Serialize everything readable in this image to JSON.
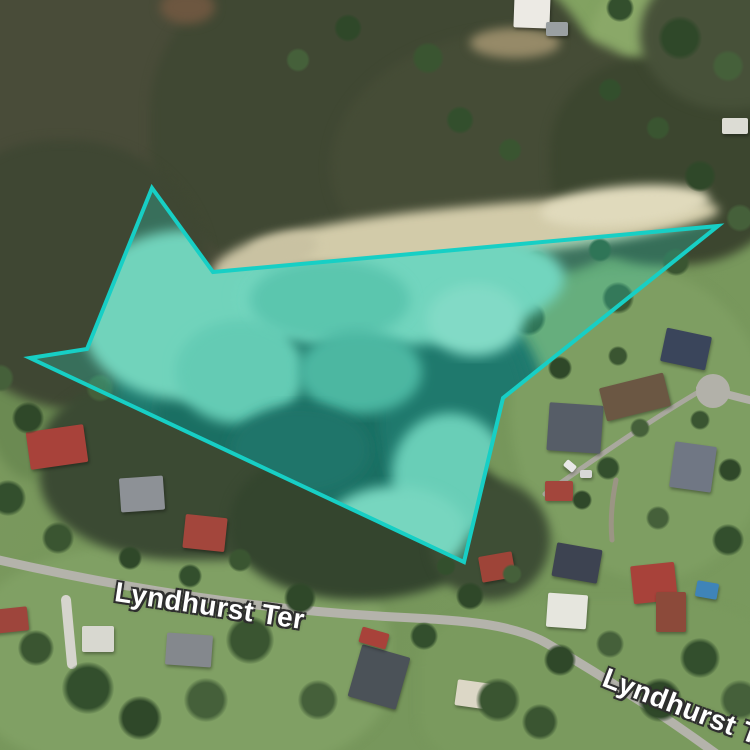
{
  "map": {
    "road_labels": [
      {
        "text": "Lyndhurst Ter",
        "x": 115,
        "y": 576,
        "rot": 8.5,
        "size": 28
      },
      {
        "text": "Lyndhurst T",
        "x": 604,
        "y": 661,
        "rot": 21,
        "size": 28
      }
    ],
    "selection": {
      "stroke_color": "#17cfc5",
      "fill_color": "rgba(38,216,196,0.28)",
      "stroke_width": 4,
      "points": [
        [
          152,
          188
        ],
        [
          213,
          272
        ],
        [
          718,
          226
        ],
        [
          503,
          398
        ],
        [
          464,
          562
        ],
        [
          30,
          358
        ],
        [
          87,
          349
        ]
      ]
    }
  },
  "scene": {
    "blobs": [
      [
        400,
        -30,
        300,
        130,
        "#82a261",
        "40% 60% 55% 45%",
        0
      ],
      [
        590,
        -30,
        180,
        140,
        "#8aa868",
        "50%",
        0
      ],
      [
        510,
        270,
        260,
        310,
        "#7e9e62",
        "40% 50% 45% 55%",
        0
      ],
      [
        -30,
        545,
        420,
        230,
        "#80a064",
        "40%",
        0
      ],
      [
        420,
        600,
        360,
        180,
        "#7a9a5e",
        "35%",
        0
      ],
      [
        -20,
        250,
        120,
        230,
        "#6b8a52",
        "45%",
        0
      ],
      [
        15,
        60,
        150,
        120,
        "#74935a",
        "50% 40% 55% 45%",
        0
      ],
      [
        -60,
        -70,
        460,
        380,
        "#494c39",
        "40% 55% 50% 45%",
        0
      ],
      [
        150,
        -60,
        450,
        340,
        "#404833",
        "50% 45% 55% 40%",
        0
      ],
      [
        -70,
        140,
        280,
        270,
        "#3f4733",
        "45% 50% 40% 55%",
        0
      ],
      [
        330,
        30,
        350,
        250,
        "#454c36",
        "55% 45% 50% 45%",
        0
      ],
      [
        550,
        55,
        240,
        210,
        "#3c462f",
        "45%",
        0
      ],
      [
        640,
        -40,
        180,
        150,
        "#475139",
        "50%",
        0
      ],
      [
        160,
        -10,
        55,
        34,
        "#6d5740",
        "50%",
        0
      ],
      [
        470,
        28,
        90,
        30,
        "#968a68",
        "50%",
        0
      ],
      [
        40,
        370,
        330,
        190,
        "#3b4a33",
        "45% 55% 50% 45%",
        0
      ],
      [
        230,
        440,
        280,
        160,
        "#34452e",
        "50% 45% 55% 45%",
        0
      ],
      [
        430,
        480,
        120,
        120,
        "#3e4e35",
        "50%",
        0
      ],
      [
        250,
        205,
        470,
        52,
        "#d2cba9",
        "45% 55% 50% 50%",
        -5.5
      ],
      [
        540,
        186,
        170,
        40,
        "#e0dabc",
        "50%",
        -5
      ],
      [
        210,
        238,
        110,
        40,
        "#c9c2a2",
        "50%",
        -18
      ]
    ],
    "roads": [
      {
        "d": "M -10 558 C 120 588, 260 610, 395 617 C 462 620, 515 624, 548 644 C 592 670, 660 712, 722 758",
        "w": 9,
        "c": "#b4b3ab"
      },
      {
        "d": "M 700 388 C 720 392, 740 398, 758 402",
        "w": 8,
        "c": "#b2b1a9"
      },
      {
        "d": "M 545 494 C 590 462, 650 420, 702 390",
        "w": 5,
        "c": "#a9a89e"
      },
      {
        "d": "M 66 600 C 68 622, 70 644, 72 664",
        "w": 10,
        "c": "#d6d5cd"
      },
      {
        "d": "M 616 480 C 612 500, 610 520, 612 540",
        "w": 5,
        "c": "#9b9584"
      }
    ],
    "road_circles": [
      [
        713,
        391,
        17,
        "#b2b1a9"
      ]
    ],
    "houses": [
      [
        28,
        428,
        58,
        38,
        -8,
        "#a8423a"
      ],
      [
        120,
        477,
        44,
        34,
        -4,
        "#8d9196"
      ],
      [
        184,
        516,
        42,
        34,
        6,
        "#a3463c"
      ],
      [
        548,
        404,
        54,
        48,
        4,
        "#565d67"
      ],
      [
        602,
        380,
        66,
        34,
        -14,
        "#6b5743"
      ],
      [
        663,
        332,
        46,
        34,
        12,
        "#3a455b"
      ],
      [
        672,
        444,
        42,
        46,
        8,
        "#707784"
      ],
      [
        545,
        481,
        28,
        20,
        0,
        "#a3463c"
      ],
      [
        554,
        546,
        46,
        34,
        10,
        "#3d4351"
      ],
      [
        632,
        564,
        44,
        38,
        -6,
        "#a8423a"
      ],
      [
        547,
        594,
        40,
        34,
        4,
        "#e6e6de"
      ],
      [
        656,
        592,
        30,
        40,
        0,
        "#8c4a3a"
      ],
      [
        696,
        582,
        22,
        16,
        10,
        "#3f84b8"
      ],
      [
        354,
        650,
        50,
        54,
        16,
        "#4b5258"
      ],
      [
        360,
        630,
        28,
        16,
        16,
        "#a8423a"
      ],
      [
        456,
        682,
        42,
        26,
        8,
        "#dcd7c6"
      ],
      [
        514,
        -6,
        36,
        34,
        2,
        "#eceae4"
      ],
      [
        546,
        22,
        22,
        14,
        0,
        "#9aa0a2"
      ],
      [
        722,
        118,
        26,
        16,
        0,
        "#dcdcd4"
      ],
      [
        82,
        626,
        32,
        26,
        0,
        "#d8d8d0"
      ],
      [
        166,
        634,
        46,
        32,
        4,
        "#84888d"
      ],
      [
        -6,
        608,
        34,
        24,
        -6,
        "#9e453c"
      ],
      [
        480,
        554,
        34,
        26,
        -10,
        "#9e4438"
      ],
      [
        564,
        462,
        12,
        8,
        40,
        "#e8e8e8"
      ],
      [
        580,
        470,
        12,
        8,
        0,
        "#d8d8d8"
      ]
    ],
    "trees": [
      [
        250,
        640,
        24
      ],
      [
        300,
        598,
        16
      ],
      [
        206,
        700,
        22
      ],
      [
        88,
        688,
        26
      ],
      [
        36,
        648,
        18
      ],
      [
        140,
        718,
        22
      ],
      [
        318,
        700,
        20
      ],
      [
        424,
        636,
        14
      ],
      [
        498,
        700,
        22
      ],
      [
        560,
        660,
        16
      ],
      [
        610,
        644,
        14
      ],
      [
        700,
        658,
        20
      ],
      [
        540,
        722,
        18
      ],
      [
        660,
        700,
        22
      ],
      [
        740,
        700,
        20
      ],
      [
        528,
        318,
        18
      ],
      [
        618,
        298,
        16
      ],
      [
        560,
        368,
        12
      ],
      [
        640,
        428,
        10
      ],
      [
        608,
        468,
        12
      ],
      [
        700,
        420,
        10
      ],
      [
        582,
        500,
        10
      ],
      [
        658,
        518,
        12
      ],
      [
        728,
        540,
        16
      ],
      [
        618,
        356,
        10
      ],
      [
        730,
        470,
        12
      ],
      [
        536,
        264,
        14
      ],
      [
        600,
        250,
        12
      ],
      [
        676,
        262,
        14
      ],
      [
        28,
        418,
        16
      ],
      [
        100,
        388,
        14
      ],
      [
        8,
        498,
        18
      ],
      [
        58,
        538,
        16
      ],
      [
        130,
        558,
        12
      ],
      [
        0,
        378,
        14
      ],
      [
        190,
        576,
        12
      ],
      [
        240,
        560,
        12
      ],
      [
        680,
        38,
        22
      ],
      [
        728,
        66,
        16
      ],
      [
        620,
        8,
        14
      ],
      [
        658,
        128,
        12
      ],
      [
        700,
        176,
        16
      ],
      [
        740,
        218,
        14
      ],
      [
        610,
        90,
        12
      ],
      [
        428,
        58,
        16
      ],
      [
        348,
        28,
        14
      ],
      [
        298,
        60,
        12
      ],
      [
        460,
        120,
        14
      ],
      [
        510,
        150,
        12
      ],
      [
        470,
        596,
        14
      ],
      [
        512,
        574,
        10
      ],
      [
        446,
        566,
        10
      ]
    ],
    "tree_palette": [
      "#3a5531",
      "#2f4829",
      "#45603a",
      "#334f2d"
    ],
    "water": [
      [
        330,
        400,
        215,
        145,
        "#1d574e",
        0
      ],
      [
        300,
        415,
        145,
        100,
        "#15463e",
        0
      ],
      [
        455,
        420,
        75,
        115,
        "#1c544c",
        0
      ],
      [
        185,
        315,
        105,
        85,
        "#8ed2b8",
        0
      ],
      [
        400,
        288,
        165,
        58,
        "#8fd4bb",
        -4
      ],
      [
        240,
        372,
        65,
        52,
        "#7cc7ae",
        0
      ],
      [
        330,
        300,
        80,
        40,
        "#6fbfa6",
        0
      ],
      [
        360,
        372,
        62,
        42,
        "#5aab94",
        0
      ],
      [
        475,
        320,
        48,
        36,
        "#a5dcc6",
        0
      ],
      [
        300,
        450,
        70,
        45,
        "#1a4f47",
        0
      ],
      [
        450,
        475,
        58,
        62,
        "#83cbb2",
        0
      ],
      [
        395,
        532,
        72,
        46,
        "#96d6bd",
        0
      ]
    ]
  }
}
